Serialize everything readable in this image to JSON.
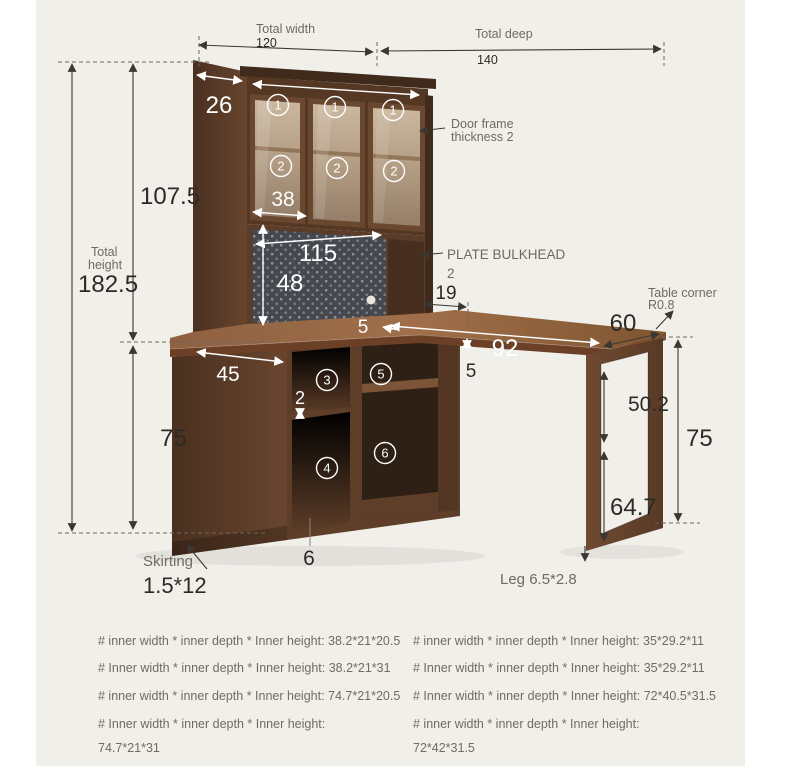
{
  "labels": {
    "total_width": "Total width",
    "total_width_value": "120",
    "total_deep": "Total deep",
    "total_deep_value": "140",
    "side_depth": "26",
    "door_width": "38",
    "pegboard_width": "115",
    "pegboard_height": "48",
    "upper_height": "107.5",
    "total_height_line1": "Total",
    "total_height_line2": "height",
    "total_height_value": "182.5",
    "lower_height": "75",
    "cabinet_depth": "45",
    "drawer_gap": "2",
    "desk_overhang": "5",
    "desk_length": "92",
    "desk_thickness": "5",
    "back_offset": "19",
    "desk_depth": "60",
    "leg_inner_height": "50.2",
    "desk_height": "75",
    "leg_lower_height": "64.7",
    "base_height": "6",
    "skirting": "Skirting",
    "skirting_value": "1.5*12",
    "leg_label": "Leg 6.5*2.8"
  },
  "annotations": {
    "door_frame_line1": "Door frame",
    "door_frame_line2": "thickness 2",
    "plate_bulkhead_line1": "PLATE BULKHEAD",
    "plate_bulkhead_line2": "2",
    "table_corner_line1": "Table corner",
    "table_corner_line2": "R0.8"
  },
  "circled": {
    "one": "1",
    "two": "2",
    "three": "3",
    "four": "4",
    "five": "5",
    "six": "6"
  },
  "specs": {
    "left": [
      "# inner width * inner depth * Inner height: 38.2*21*20.5",
      "# Inner width * inner depth * Inner height: 38.2*21*31",
      "# inner width * inner depth * Inner height: 74.7*21*20.5",
      "# Inner width * inner depth * Inner height:",
      "74.7*21*31"
    ],
    "right": [
      "# inner width * inner depth * Inner height: 35*29.2*11",
      "# Inner width * inner depth * Inner height: 35*29.2*11",
      "# Inner width * inner depth * Inner height: 72*40.5*31.5",
      "# inner width * inner depth * Inner height:",
      "72*42*31.5"
    ]
  },
  "colors": {
    "background": "#f1efe9",
    "wood_dark": "#4a3020",
    "wood_mid": "#6b4730",
    "wood_light": "#8a5c3c",
    "pegboard": "#45484e",
    "dimension_line": "#3b3833",
    "text_gray": "#6e6a63",
    "text_dark": "#2d2a26"
  }
}
